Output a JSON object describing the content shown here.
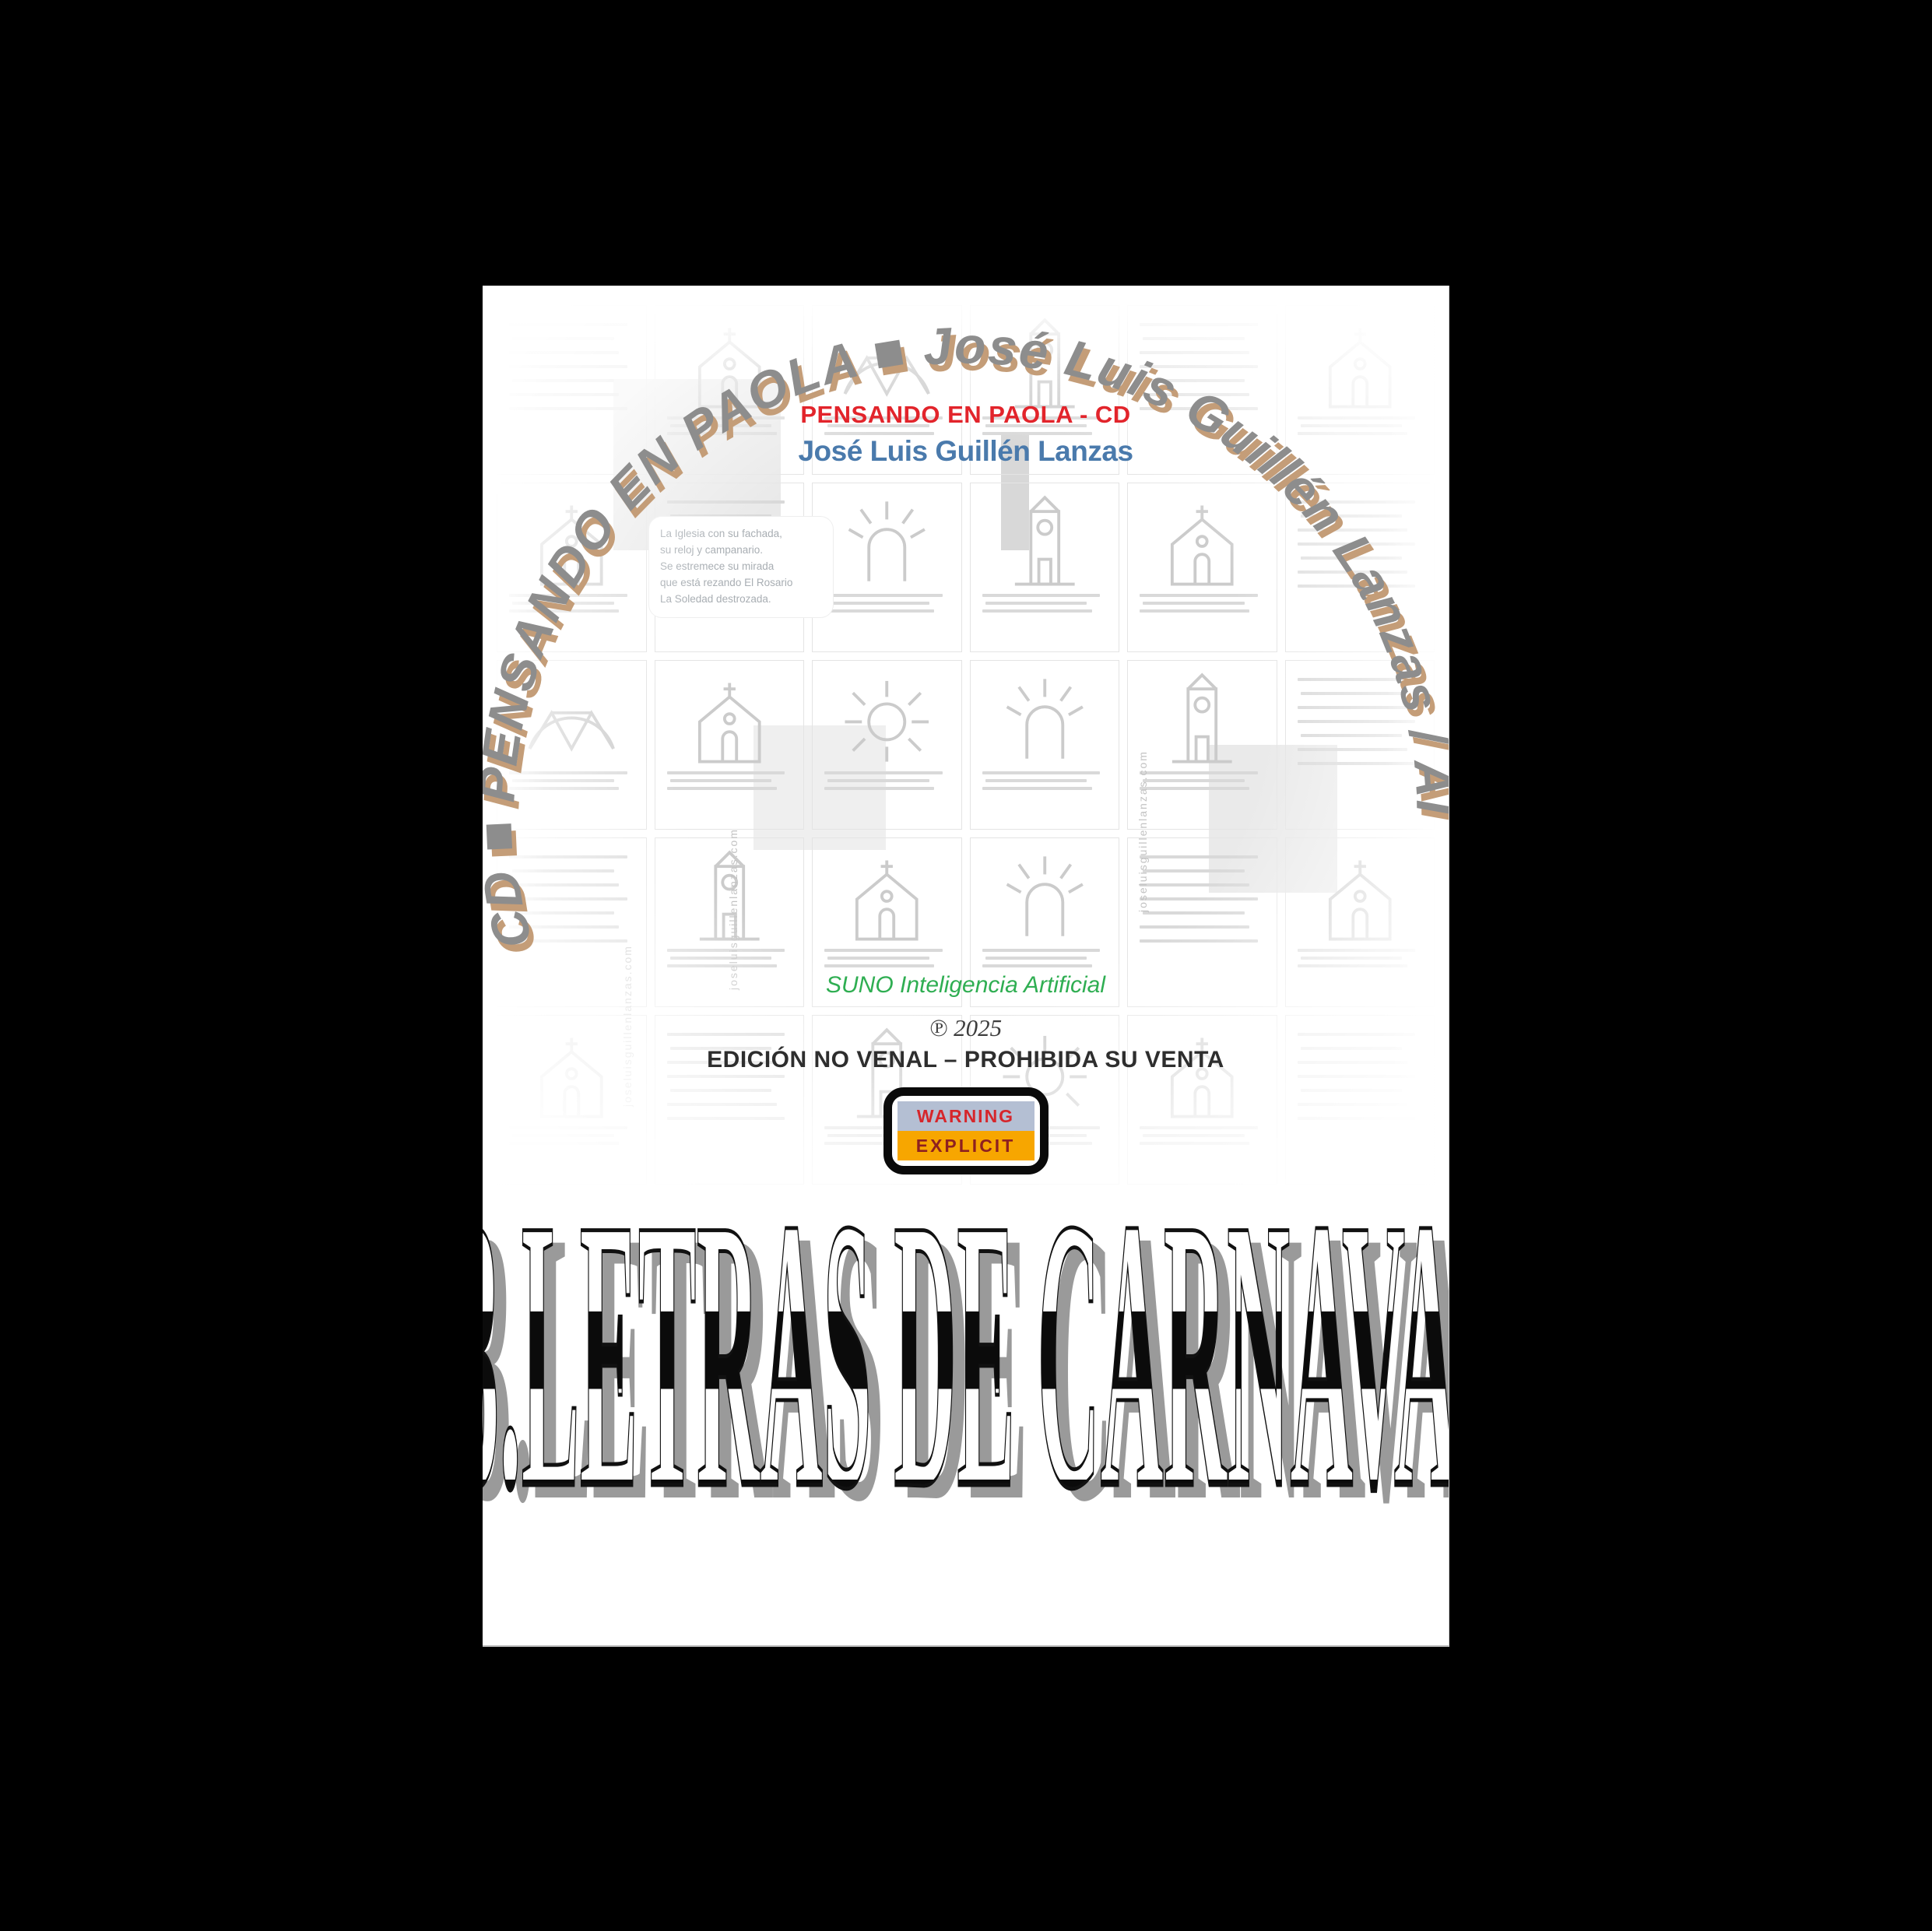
{
  "window": {
    "background": "#000000"
  },
  "page": {
    "arc_title": "CD ■ PENSANDO EN PAOLA ■ José Luis Guillén Lanzas / AI",
    "header": {
      "album_title": "PENSANDO EN PAOLA - CD",
      "artist": "José Luis Guillén Lanzas"
    },
    "credits": {
      "ai_credit": "SUNO Inteligencia Artificial",
      "phonogram": "℗ 2025",
      "edition_notice": "EDICIÓN NO VENAL – PROHIBIDA SU VENTA"
    },
    "advisory": {
      "top": "WARNING",
      "bottom": "EXPLICIT"
    },
    "track_title": "13.LETRAS DE CARNAVAL",
    "collage": {
      "website": "joseluisguillenlanzas.com",
      "poem": {
        "lines": [
          "La Iglesia con su fachada,",
          "su reloj y campanario.",
          "Se estremece su mirada",
          "que está rezando El Rosario",
          "La Soledad destrozada."
        ]
      },
      "cards": [
        "text",
        "church",
        "bridge",
        "tower",
        "text",
        "church",
        "church",
        "text",
        "arch",
        "tower",
        "church",
        "text",
        "bridge",
        "church",
        "sun",
        "arch",
        "tower",
        "text",
        "text",
        "tower",
        "church",
        "arch",
        "text",
        "church",
        "church",
        "text",
        "tower",
        "sun",
        "church",
        "text"
      ]
    },
    "colors": {
      "album_title": "#e2242b",
      "artist": "#4a7aac",
      "ai_credit": "#2fae52",
      "arc_fill": "#8d8d8d",
      "arc_shadow": "#c49d78",
      "advisory_top_bg": "#b4bfd3",
      "advisory_top_text": "#d6262b",
      "advisory_bottom_bg": "#f7a600",
      "advisory_bottom_text": "#8e2020",
      "title_shadow": "#9a9a9a"
    }
  }
}
